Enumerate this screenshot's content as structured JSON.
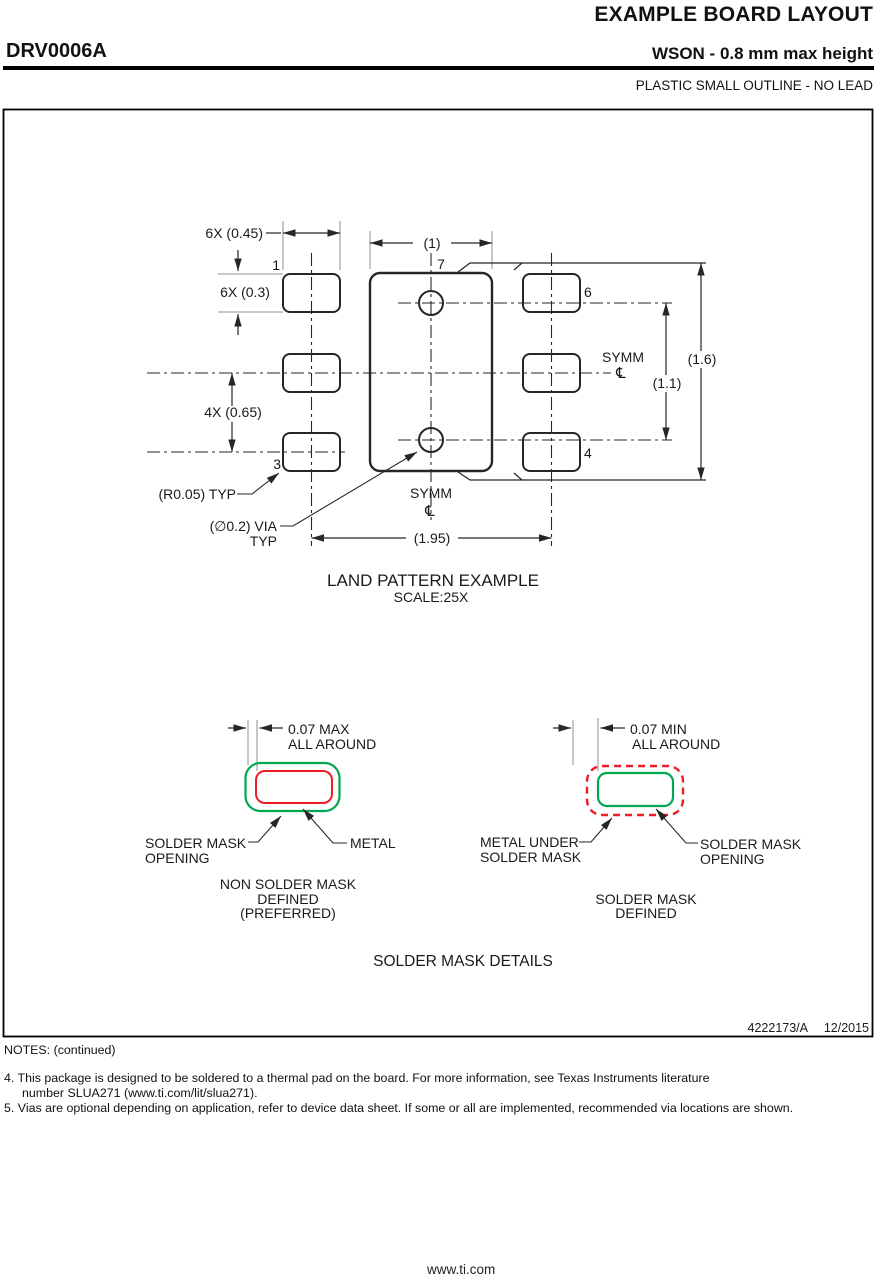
{
  "header": {
    "sheet_title": "EXAMPLE BOARD LAYOUT",
    "part_number": "DRV0006A",
    "package_type": "WSON - 0.8 mm max height",
    "package_family": "PLASTIC SMALL OUTLINE - NO LEAD"
  },
  "land_pattern": {
    "title": "LAND PATTERN EXAMPLE",
    "scale": "SCALE:25X",
    "pins": {
      "pin1": "1",
      "pin3": "3",
      "pin4": "4",
      "pin6": "6",
      "pin7": "7"
    },
    "dims": {
      "pad_width": "6X (0.45)",
      "pad_height": "6X (0.3)",
      "pad_pitch": "4X (0.65)",
      "thermal_width": "(1)",
      "outline_height": "(1.6)",
      "via_pitch": "(1.1)",
      "pad_span": "(1.95)",
      "corner_radius": "(R0.05) TYP",
      "via_line1": "(∅0.2) VIA",
      "via_line2": "TYP",
      "symm": "SYMM",
      "centerline": "℄"
    }
  },
  "solder_mask": {
    "section_title": "SOLDER MASK DETAILS",
    "nsmd": {
      "dim_line1": "0.07 MAX",
      "dim_line2": "ALL AROUND",
      "opening_line1": "SOLDER MASK",
      "opening_line2": "OPENING",
      "metal_label": "METAL",
      "caption_line1": "NON SOLDER MASK",
      "caption_line2": "DEFINED",
      "caption_line3": "(PREFERRED)"
    },
    "smd": {
      "dim_line1": "0.07 MIN",
      "dim_line2": "ALL AROUND",
      "metal_line1": "METAL UNDER",
      "metal_line2": "SOLDER MASK",
      "opening_line1": "SOLDER MASK",
      "opening_line2": "OPENING",
      "caption_line1": "SOLDER MASK",
      "caption_line2": "DEFINED"
    }
  },
  "title_block": {
    "doc_number": "4222173/A",
    "revision_date": "12/2015"
  },
  "notes": {
    "heading": "NOTES: (continued)",
    "note4_line1": "4. This package is designed to be soldered to a thermal pad on the board. For more information, see Texas Instruments literature",
    "note4_line2": "number SLUA271 (www.ti.com/lit/slua271).",
    "note5": "5. Vias are optional depending on application, refer to device data sheet. If some or all are implemented, recommended via locations are shown."
  },
  "footer": {
    "url": "www.ti.com"
  },
  "colors": {
    "metal_red": "#ee1c25",
    "mask_green": "#00a651",
    "line_black": "#262626",
    "extension_gray": "#a7a9ac"
  }
}
